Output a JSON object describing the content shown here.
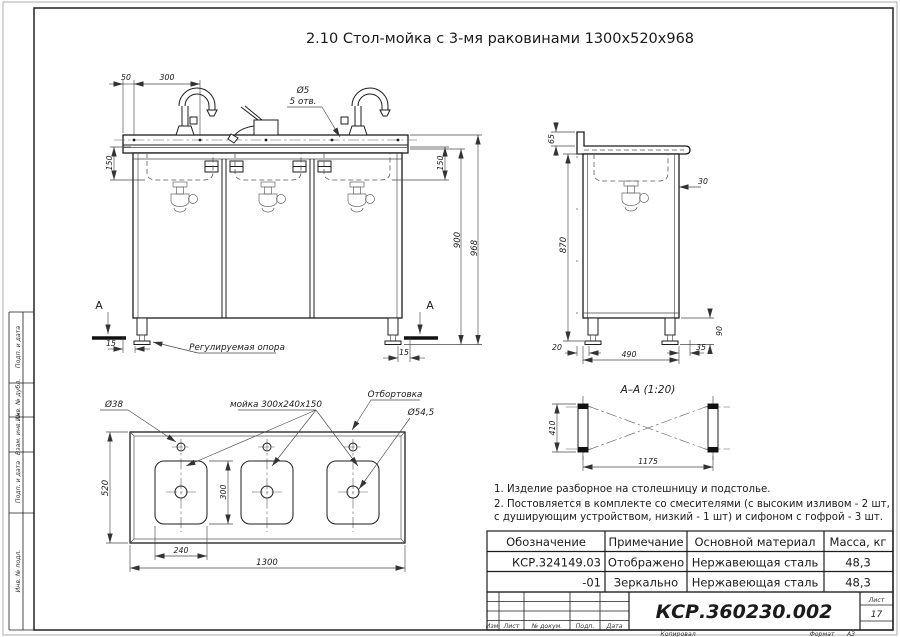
{
  "page": {
    "title": "2.10 Стол-мойка с 3-мя раковинами 1300х520х968",
    "footer": {
      "kopiroval": "Копировал",
      "format_label": "Формат",
      "format_value": "А3"
    }
  },
  "front_view": {
    "dim_50": "50",
    "dim_300": "300",
    "hole_callout_dia": "Ø5",
    "hole_callout_qty": "5 отв.",
    "dim_150_left": "150",
    "dim_150_right": "150",
    "dim_900": "900",
    "dim_968": "968",
    "dim_15_left": "15",
    "dim_15_right": "15",
    "support_label": "Регулируемая опора",
    "section_letter_left": "А",
    "section_letter_right": "А"
  },
  "side_view": {
    "dim_65": "65",
    "dim_870": "870",
    "dim_30": "30",
    "dim_90": "90",
    "dim_20": "20",
    "dim_490": "490",
    "dim_35": "35"
  },
  "section_aa": {
    "title": "А–А (1:20)",
    "dim_410": "410",
    "dim_1175": "1175"
  },
  "plan_view": {
    "dim_520": "520",
    "dim_300": "300",
    "dim_240": "240",
    "dim_1300": "1300",
    "callout_faucet_hole": "Ø38",
    "callout_sink": "мойка 300х240х150",
    "callout_flange": "Отбортовка",
    "callout_drain": "Ø54,5"
  },
  "notes": [
    "1. Изделие разборное на столешницу и подстолье.",
    "2. Постовляется в комплекте со смесителями (с высоким изливом - 2 шт,",
    "с душирующим устройством, низкий - 1 шт) и сифоном с гофрой - 3 шт."
  ],
  "spec_table": {
    "headers": [
      "Обозначение",
      "Примечание",
      "Основной материал",
      "Масса, кг"
    ],
    "rows": [
      [
        "КСР.324149.03",
        "Отображено",
        "Нержавеющая сталь",
        "48,3"
      ],
      [
        "-01",
        "Зеркально",
        "Нержавеющая сталь",
        "48,3"
      ]
    ]
  },
  "title_block": {
    "doc_number": "КСР.360230.002",
    "rev_columns": [
      "Изм.",
      "Лист",
      "№ докум.",
      "Подп.",
      "Дата"
    ],
    "sheet_label": "Лист",
    "sheet_number": "17"
  },
  "border_stamps": [
    "Подп. и дата",
    "Инв. № дубл.",
    "Взам. инв. №",
    "Подп. и дата",
    "Инв. № подл."
  ]
}
